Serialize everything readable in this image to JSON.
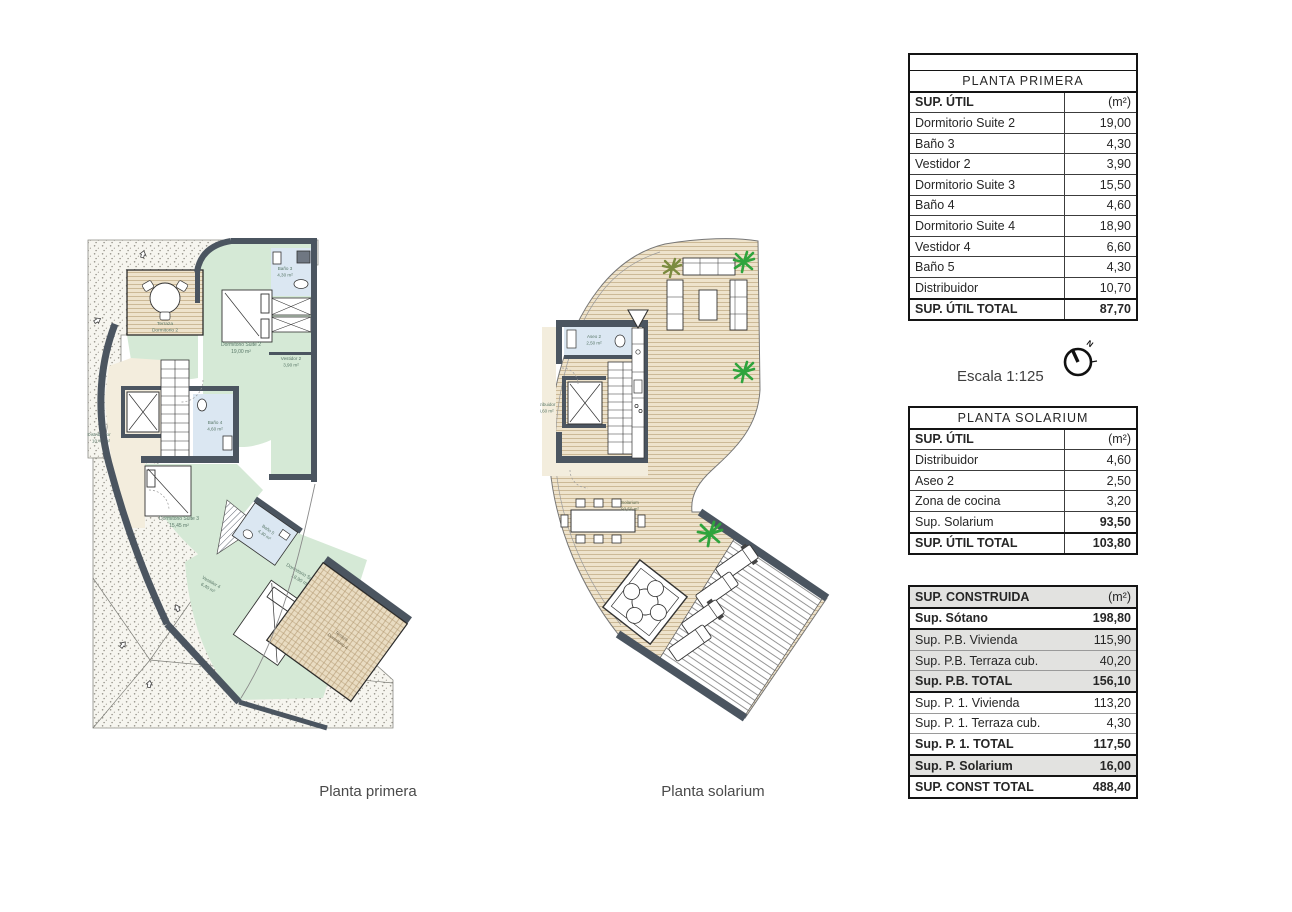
{
  "captions": {
    "left_plan": "Planta primera",
    "right_plan": "Planta solarium"
  },
  "scale": {
    "text": "Escala 1:125",
    "north_label": "N"
  },
  "tables": {
    "planta_primera": {
      "title": "PLANTA PRIMERA",
      "header": {
        "label": "SUP. ÚTIL",
        "unit": "(m²)"
      },
      "rows": [
        {
          "label": "Dormitorio Suite 2",
          "value": "19,00"
        },
        {
          "label": "Baño 3",
          "value": "4,30"
        },
        {
          "label": "Vestidor 2",
          "value": "3,90"
        },
        {
          "label": "Dormitorio Suite 3",
          "value": "15,50"
        },
        {
          "label": "Baño 4",
          "value": "4,60"
        },
        {
          "label": "Dormitorio Suite 4",
          "value": "18,90"
        },
        {
          "label": "Vestidor 4",
          "value": "6,60"
        },
        {
          "label": "Baño 5",
          "value": "4,30"
        },
        {
          "label": "Distribuidor",
          "value": "10,70"
        }
      ],
      "total": {
        "label": "SUP. ÚTIL TOTAL",
        "value": "87,70"
      }
    },
    "planta_solarium": {
      "title": "PLANTA SOLARIUM",
      "header": {
        "label": "SUP. ÚTIL",
        "unit": "(m²)"
      },
      "rows": [
        {
          "label": "Distribuidor",
          "value": "4,60"
        },
        {
          "label": "Aseo 2",
          "value": "2,50"
        },
        {
          "label": "Zona de cocina",
          "value": "3,20"
        },
        {
          "label": "Sup. Solarium",
          "value": "93,50"
        }
      ],
      "total": {
        "label": "SUP. ÚTIL TOTAL",
        "value": "103,80"
      }
    },
    "sup_construida": {
      "header": {
        "label": "SUP. CONSTRUIDA",
        "unit": "(m²)"
      },
      "rows": [
        {
          "label": "Sup. Sótano",
          "value": "198,80"
        },
        {
          "label": "Sup. P.B. Vivienda",
          "value": "115,90"
        },
        {
          "label": "Sup. P.B. Terraza cub.",
          "value": "40,20"
        },
        {
          "label": "Sup. P.B. TOTAL",
          "value": "156,10"
        },
        {
          "label": "Sup. P. 1. Vivienda",
          "value": "113,20"
        },
        {
          "label": "Sup. P. 1. Terraza cub.",
          "value": "4,30"
        },
        {
          "label": "Sup. P. 1. TOTAL",
          "value": "117,50"
        },
        {
          "label": "Sup. P. Solarium",
          "value": "16,00"
        },
        {
          "label": "SUP. CONST TOTAL",
          "value": "488,40"
        }
      ]
    }
  },
  "plans": {
    "primera": {
      "rooms": [
        {
          "name": "Terraza",
          "detail": "Dormitorio 2"
        },
        {
          "name": "Dormitorio Suite 2",
          "detail": "19,00 m²"
        },
        {
          "name": "Baño 3",
          "detail": "4,30 m²"
        },
        {
          "name": "Vestidor 2",
          "detail": "3,90 m²"
        },
        {
          "name": "Distribuidor",
          "detail": "10,40 m²"
        },
        {
          "name": "Baño 4",
          "detail": "4,60 m²"
        },
        {
          "name": "Dormitorio Suite 3",
          "detail": "15,45 m²"
        },
        {
          "name": "Baño 5",
          "detail": "4,30 m²"
        },
        {
          "name": "Vestidor 4",
          "detail": "6,40 m²"
        },
        {
          "name": "Dormitorio Suite 4",
          "detail": "18,90 m²"
        },
        {
          "name": "Terraza",
          "detail": "Dormitorio 4"
        }
      ]
    },
    "solarium": {
      "rooms": [
        {
          "name": "Aseo 2",
          "detail": "2,50 m²"
        },
        {
          "name": "Distribuidor",
          "detail": "4,60 m²"
        },
        {
          "name": "Solarium",
          "detail": "93,50 m²"
        }
      ]
    }
  },
  "colors": {
    "wall": "#4b5560",
    "room_green": "#d5e9d6",
    "room_blue": "#dbe7f2",
    "room_cream": "#f3eddd",
    "deck": "#eee3cc",
    "plant": "#2fa43d"
  }
}
